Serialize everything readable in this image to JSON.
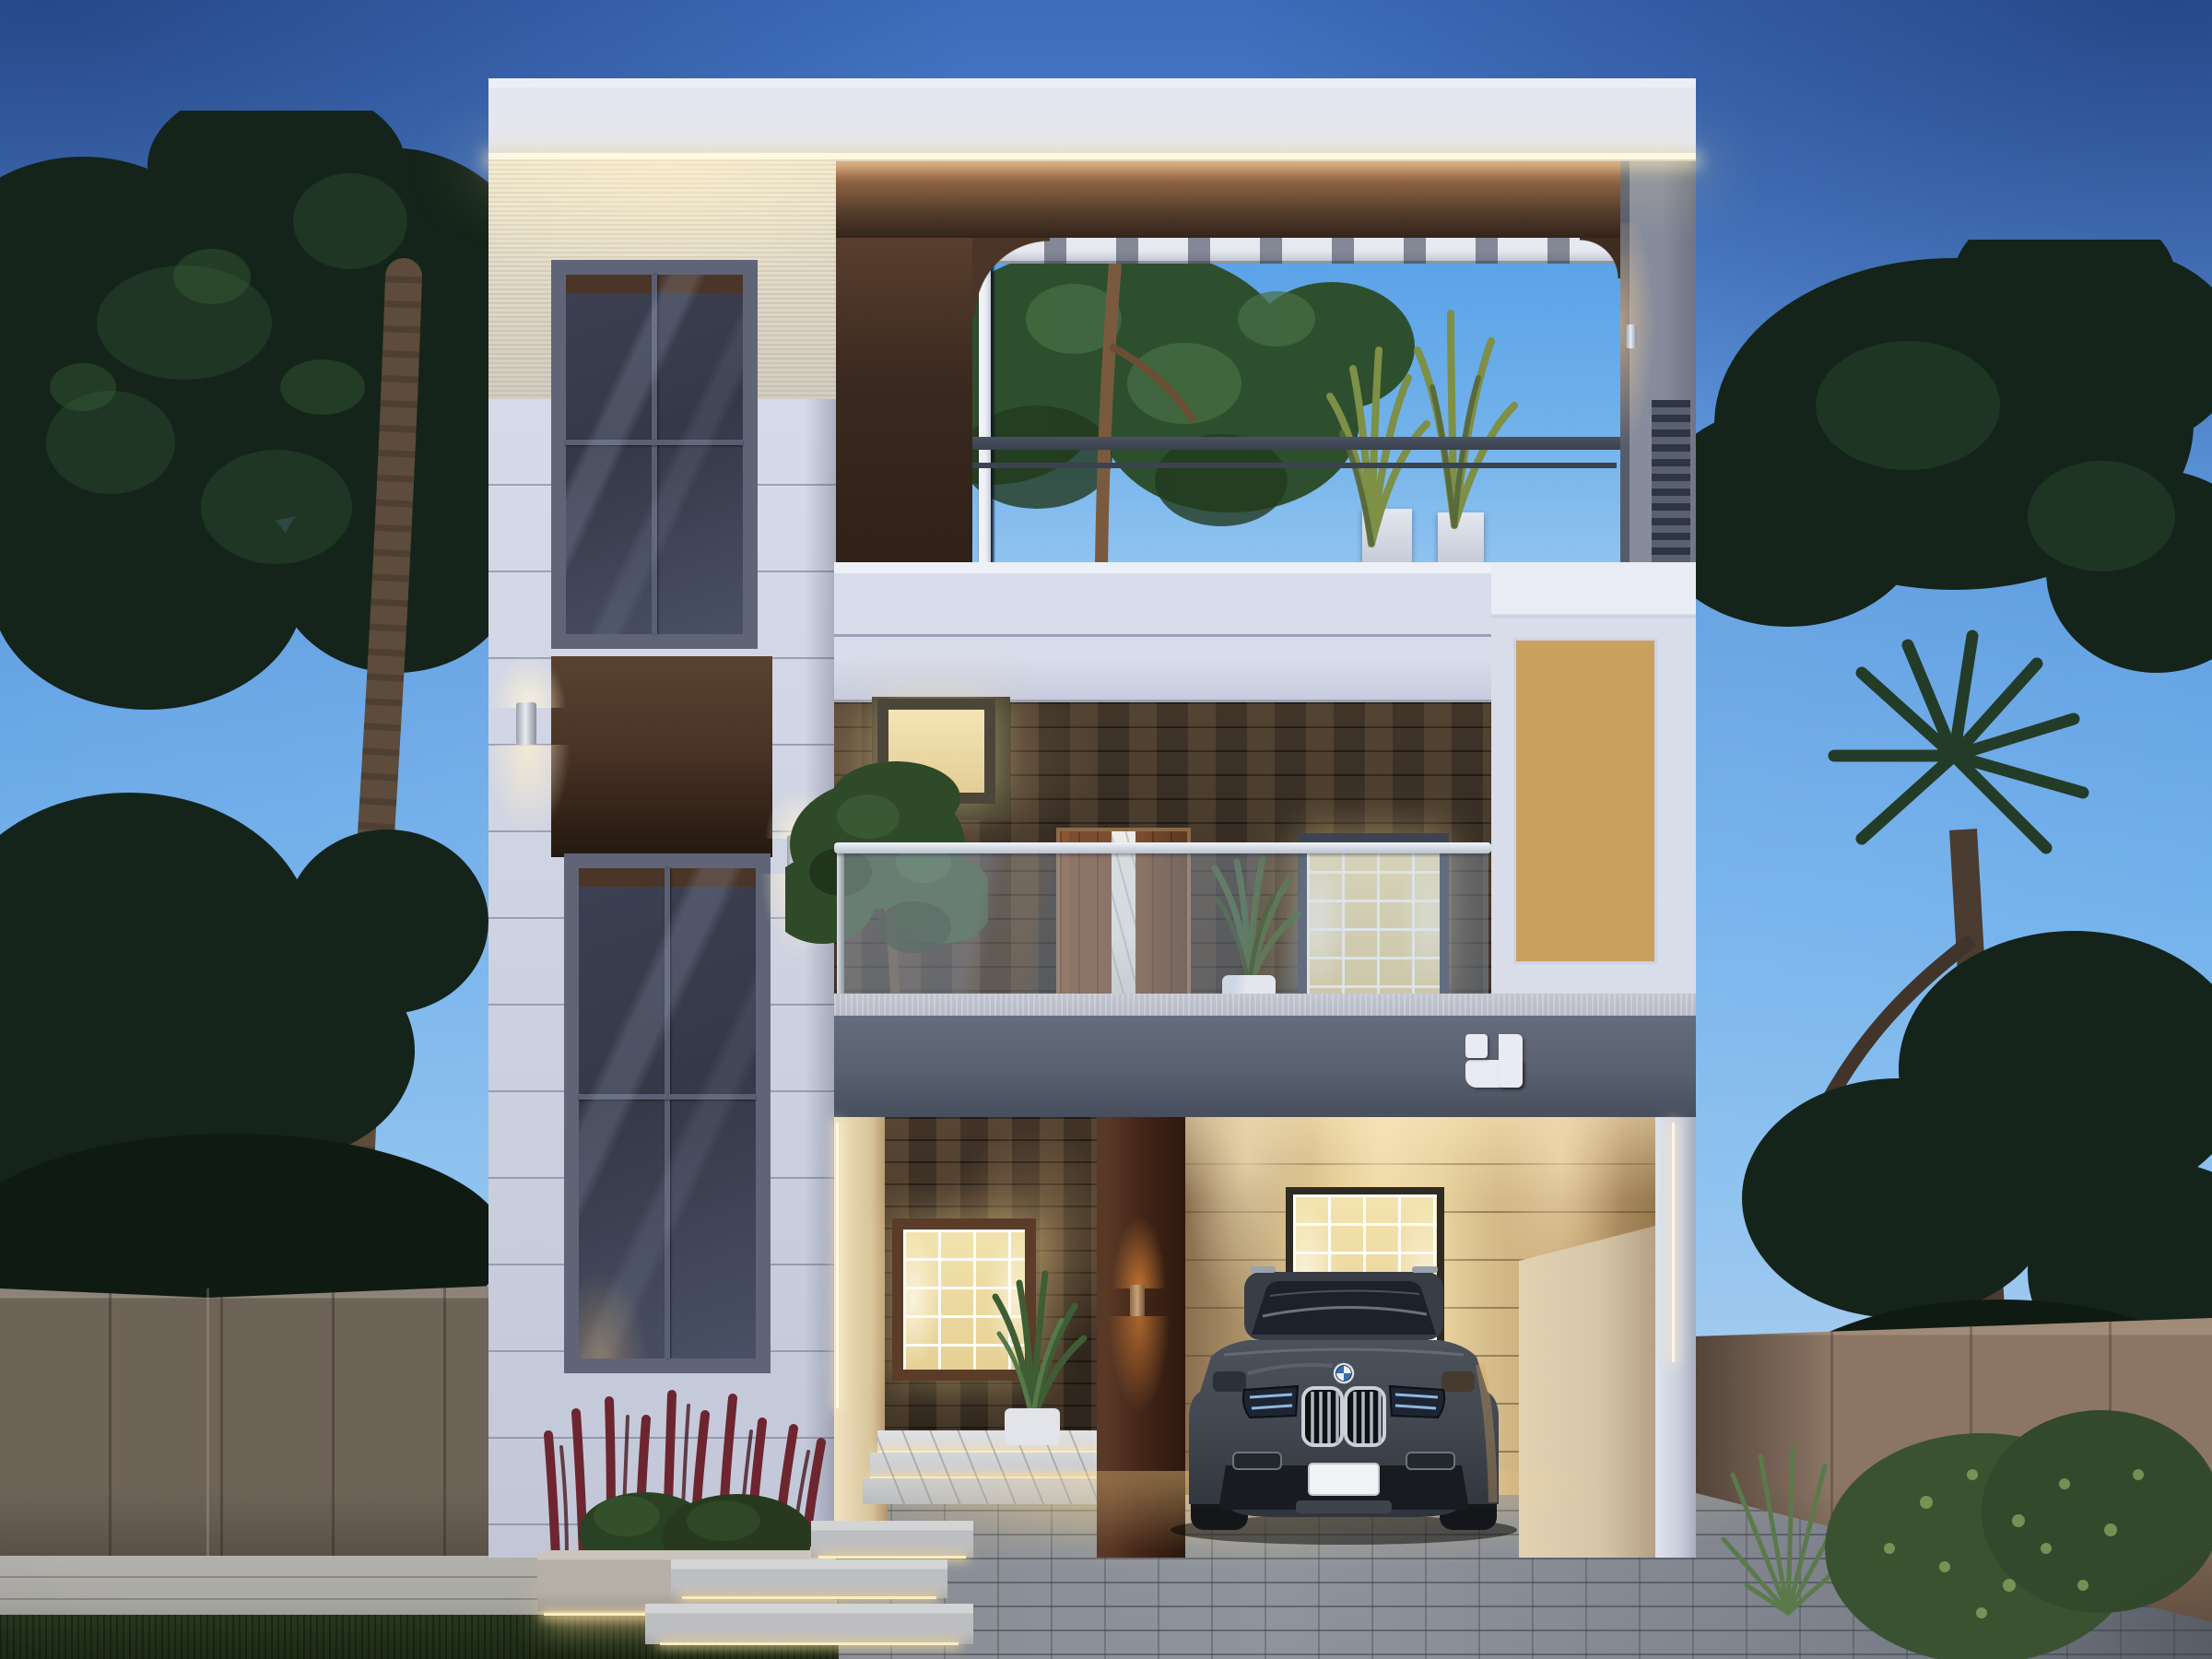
{
  "scene": {
    "type": "architectural-exterior-render",
    "description": "Modern two-storey duplex house at dusk: white facade with LED cove lighting, brown fascia with arched white-slat screen over a roof terrace, dark metal terrace railing, glass balcony balustrade, stone-clad first floor with wooden door and marble inlay, backlit terracotta jali screen, gray porch band with white corner-bracket logo, dark gray BMW SUV parked in the warm-lit porch, paver driveway, compound walls and flanking trees",
    "time_of_day": "dusk",
    "storeys": 2,
    "lighting": [
      "roof LED strip",
      "cylindrical up-down wall sconces",
      "orange porch sconces",
      "backlit jali",
      "step LED strips",
      "under-planter LED"
    ]
  },
  "palette": {
    "sky-top": "#3d6cba",
    "sky-mid": "#62a0e2",
    "sky-low": "#8fc2ef",
    "sky-horizon": "#bcd5ef",
    "opening-sky": "#6fb0ea",
    "tree-dark": "#14241a",
    "tree-mid": "#223a27",
    "tree-light": "#3f6a3c",
    "trunk": "#5d4b3b",
    "wall-left": "#6e6357",
    "wall-left-coping": "#8d8378",
    "wall-right": "#8b7565",
    "wall-right-coping": "#a08b77",
    "grass": "#27371f",
    "walkway": "#aaa9a4",
    "paver": "#8f949c",
    "white-wall": "#d7dbe9",
    "white-hi": "#eef0f7",
    "parapet": "#e4e7f1",
    "texture-warm": "#f2e9d2",
    "led": "#fff7df",
    "frame-gray": "#5f6576",
    "glass-dark": "#343847",
    "glass-mid": "#4a5065",
    "brown-lit": "#b26f44",
    "brown": "#6b4a35",
    "brown-dark": "#2f2118",
    "tower-brown": "#4a3426",
    "slat": "#eef0f6",
    "railing": "#39404e",
    "pillar-gray": "#868c9c",
    "louver-dark": "#2f3542",
    "band-white": "#d9dcea",
    "stone": "#3a3026",
    "door-wood": "#7c4e2f",
    "marble": "#ece9e3",
    "window-warm": "#f3e3ae",
    "frame-dark": "#3e4350",
    "jali": "#a3422b",
    "jali-solid": "#c65c40",
    "jali-glow": "#d9a868",
    "jali-bg": "#caa05f",
    "gray-band": "#59616f",
    "band-lip": "#b6bac6",
    "logo": "#e8ebf3",
    "porch-wall": "#e2cd9c",
    "porch-wall-dark": "#96784f",
    "pillar-brown": "#46281a",
    "wedge": "#d6c6a8",
    "column-white": "#dfe3ee",
    "marble-step": "#d6d8da",
    "car-body": "#41464f",
    "car-dark": "#1a1d22",
    "chrome": "#c9d2da",
    "plate": "#f2f3f5",
    "red-plant": "#6d2530",
    "bush": "#2c4526",
    "planter": "#b4b0a8"
  },
  "terrace": {
    "slat_count": 7,
    "railing_bar_count": 5,
    "railing_post_count": 5
  },
  "balcony": {
    "glass_post_count": 6
  },
  "jali": {
    "cols": 5,
    "rows": 9,
    "solid_cells": [
      0,
      3,
      7,
      12,
      15,
      19,
      22,
      25,
      33,
      36,
      41,
      43
    ]
  },
  "car": {
    "make_badge": "BMW roundel",
    "style": "luxury SUV front view",
    "body_color": "#41464f",
    "plate_text": ""
  },
  "logo": {
    "shape": "white square + corner bracket",
    "color": "#e8ebf3"
  }
}
